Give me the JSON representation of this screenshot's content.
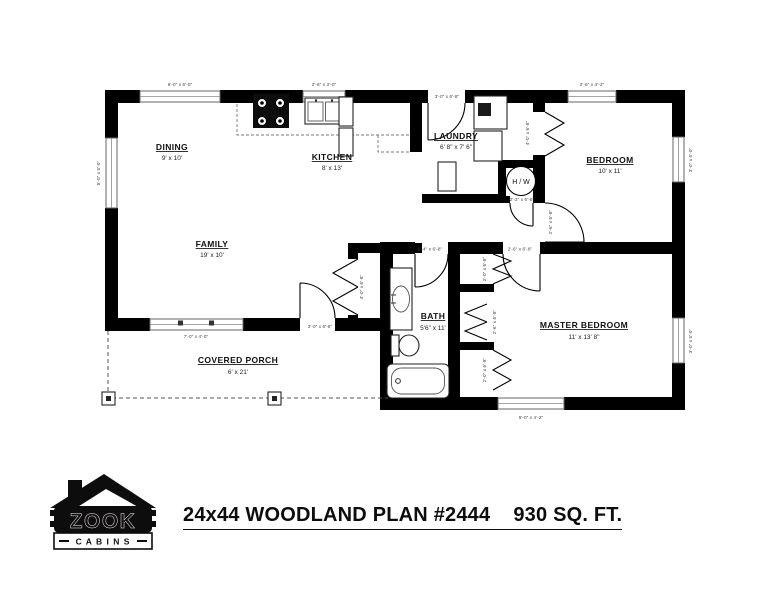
{
  "plan": {
    "title": "24x44 WOODLAND PLAN #2444    930 SQ. FT."
  },
  "logo": {
    "brand": "ZOOK",
    "sub": "C A B I N S"
  },
  "rooms": {
    "dining": {
      "name": "DINING",
      "dims": "9' x 10'"
    },
    "kitchen": {
      "name": "KITCHEN",
      "dims": "8' x 13'"
    },
    "laundry": {
      "name": "LAUNDRY",
      "dims": "6' 8\" x 7' 6\""
    },
    "bedroom": {
      "name": "BEDROOM",
      "dims": "10' x 11'"
    },
    "family": {
      "name": "FAMILY",
      "dims": "19' x 10'"
    },
    "bath": {
      "name": "BATH",
      "dims": "5'6\" x 11'"
    },
    "master": {
      "name": "MASTER BEDROOM",
      "dims": "11' x 13' 8\""
    },
    "porch": {
      "name": "COVERED PORCH",
      "dims": "6' x 21'"
    }
  },
  "fixtures": {
    "water_heater": "H / W"
  },
  "openings": {
    "w_dining": "6'-0\" x 6'-0\"",
    "w_kitchen": "2'-6\" x 3'-0\"",
    "d_laundry": "3'-0\" x 6'-8\"",
    "w_bedroom_top": "2'-6\" x 4'-2\"",
    "w_left": "5'-0\" x 5'-0\"",
    "w_bedroom_right": "3'-0\" x 5'-0\"",
    "w_master_right": "3'-0\" x 5'-0\"",
    "w_master_bottom": "5'-0\" x 4'-2\"",
    "w_family": "7'-0\" x 4'-0\"",
    "d_porch": "3'-0\" x 6'-8\"",
    "d_family_closet": "4'-0\" x 6'-8\"",
    "d_bedroom_closet": "4'-0\" x 6'-8\"",
    "d_bedroom": "2'-6\" x 6'-8\"",
    "d_hw": "2'-2\" x 6'-8\"",
    "d_master": "2'-6\" x 6'-8\"",
    "d_bath": "2'-4\" x 6'-8\"",
    "c_master_1": "2'-0\" x 6'-8\"",
    "c_master_2": "2'-6\" x 6'-8\"",
    "c_master_3": "2'-0\" x 6'-8\""
  }
}
